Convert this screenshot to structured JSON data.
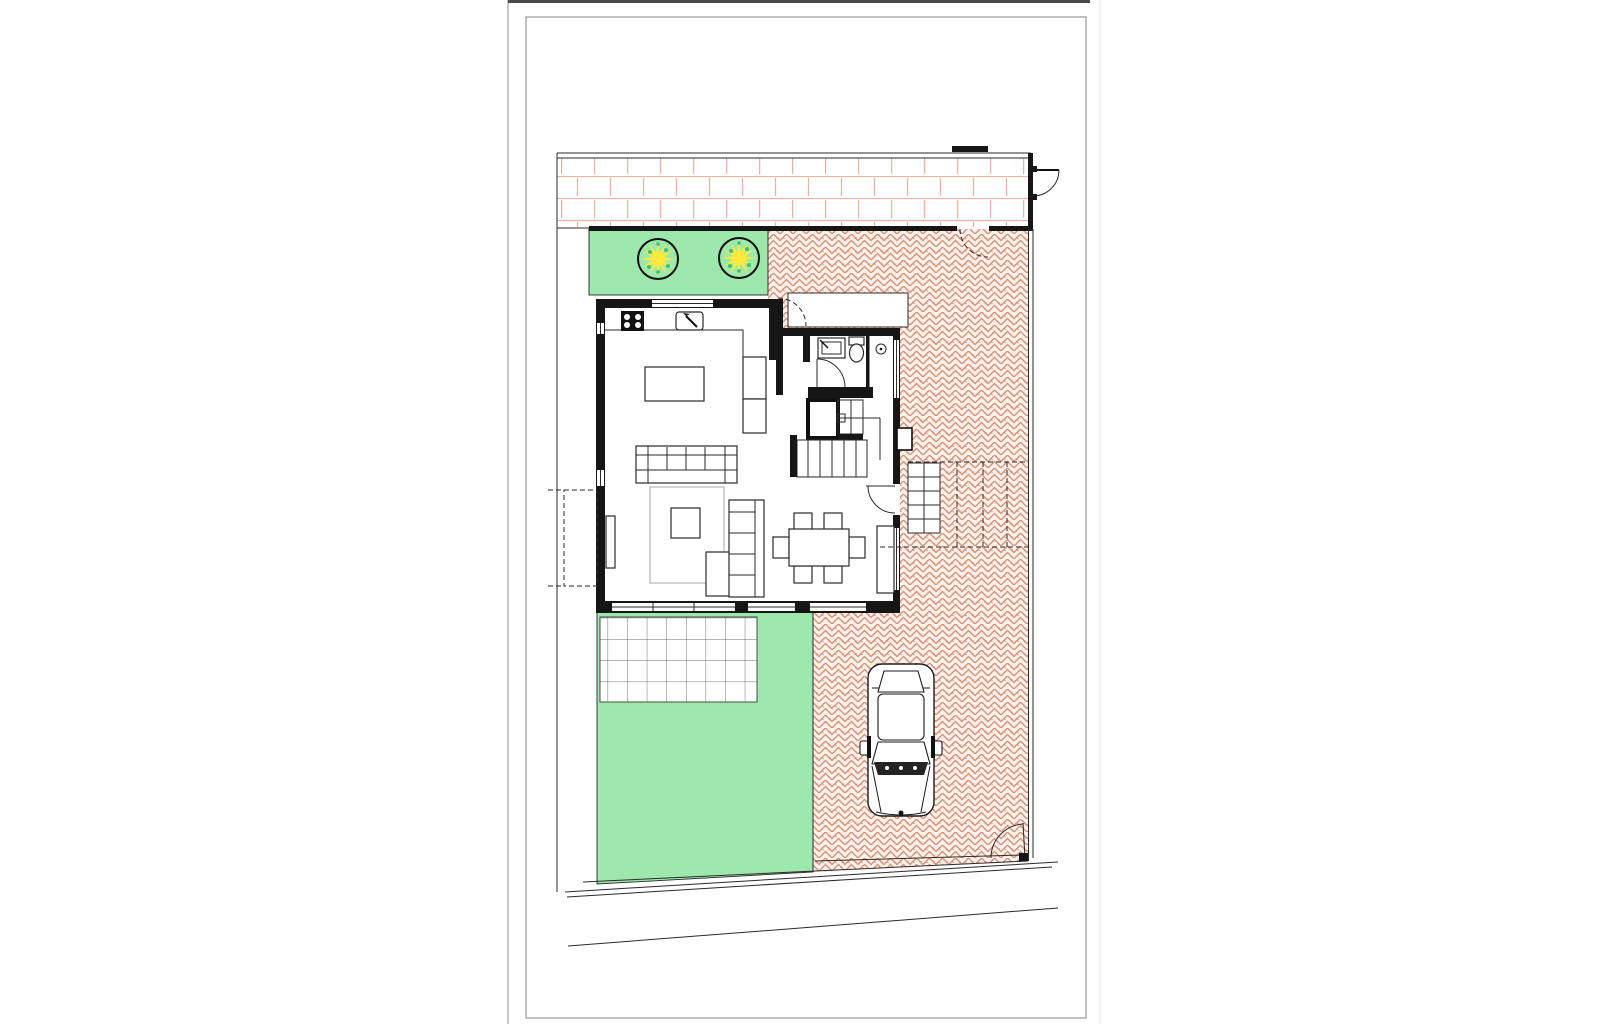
{
  "scene": {
    "type": "architectural-site-plan",
    "description": "Ground floor plan of a detached house on a plot: street and sidewalk at top, front lawn with two trees, open-plan kitchen/living/dining house, bathroom and staircase, rear lawn with tiled terrace, herringbone-paved courtyard and driveway with one parked car, three gate swings and boundary fences.",
    "tree_count": 2,
    "vehicle_count": 1,
    "dining_chair_count": 6,
    "sofa_count": 2,
    "stair_flight_count": 2,
    "gate_count": 3
  },
  "colors": {
    "lawn": "#9de8ac",
    "tree_foliage": "#ffe93d",
    "tree_fleck": "#3fbf6f",
    "tree_outline": "#111111",
    "paving_stroke": "#d6917b",
    "paving_bg": "#fdf1ea",
    "sidewalk_stroke": "#eab4a3",
    "wall": "#161616",
    "line": "#2a2a2a",
    "rug": "#b8b8b8",
    "frame": "#999999",
    "page_edge": "#b3b3b3",
    "page_top": "#4a4a4a"
  }
}
